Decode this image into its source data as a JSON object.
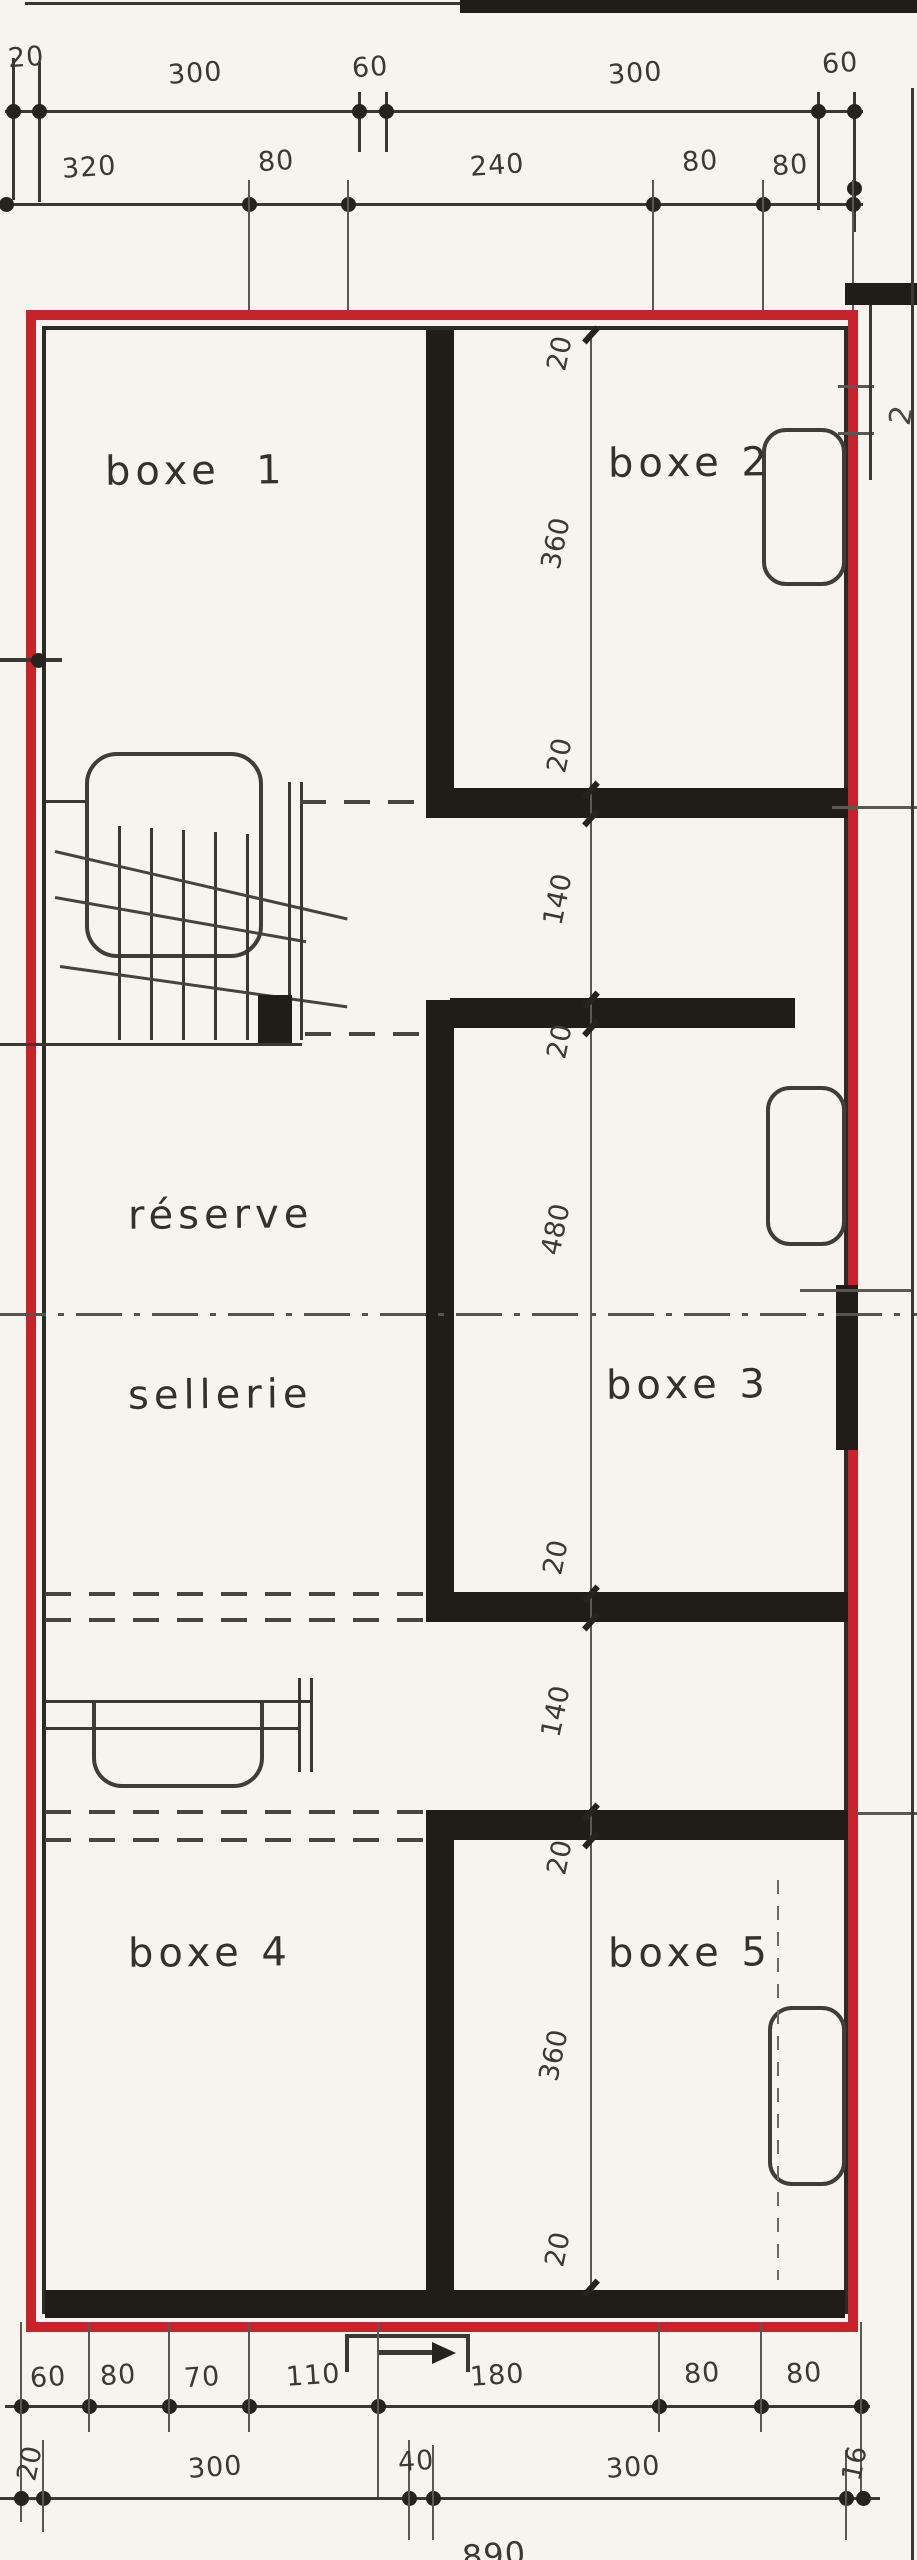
{
  "plan": {
    "rooms": {
      "boxe1": "boxe  1",
      "boxe2": "boxe 2",
      "boxe3": "boxe 3",
      "boxe4": "boxe 4",
      "boxe5": "boxe 5",
      "reserve": "réserve",
      "sellerie": "sellerie"
    },
    "top_row1": [
      "20",
      "300",
      "60",
      "300",
      "60"
    ],
    "top_row2": [
      "320",
      "80",
      "240",
      "80",
      "80"
    ],
    "chain": [
      "20",
      "360",
      "20",
      "140",
      "20",
      "480",
      "20",
      "140",
      "20",
      "360",
      "20"
    ],
    "bottom_row1": [
      "60",
      "80",
      "70",
      "110",
      "180",
      "80",
      "80"
    ],
    "bottom_row2": [
      "20",
      "300",
      "40",
      "300",
      "16"
    ],
    "bottom_row3": [
      "890"
    ],
    "edge_fragment": "2",
    "colors": {
      "outline_red": "#c8232b",
      "wall_black": "#201d18",
      "paper": "#f6f4ee"
    }
  }
}
